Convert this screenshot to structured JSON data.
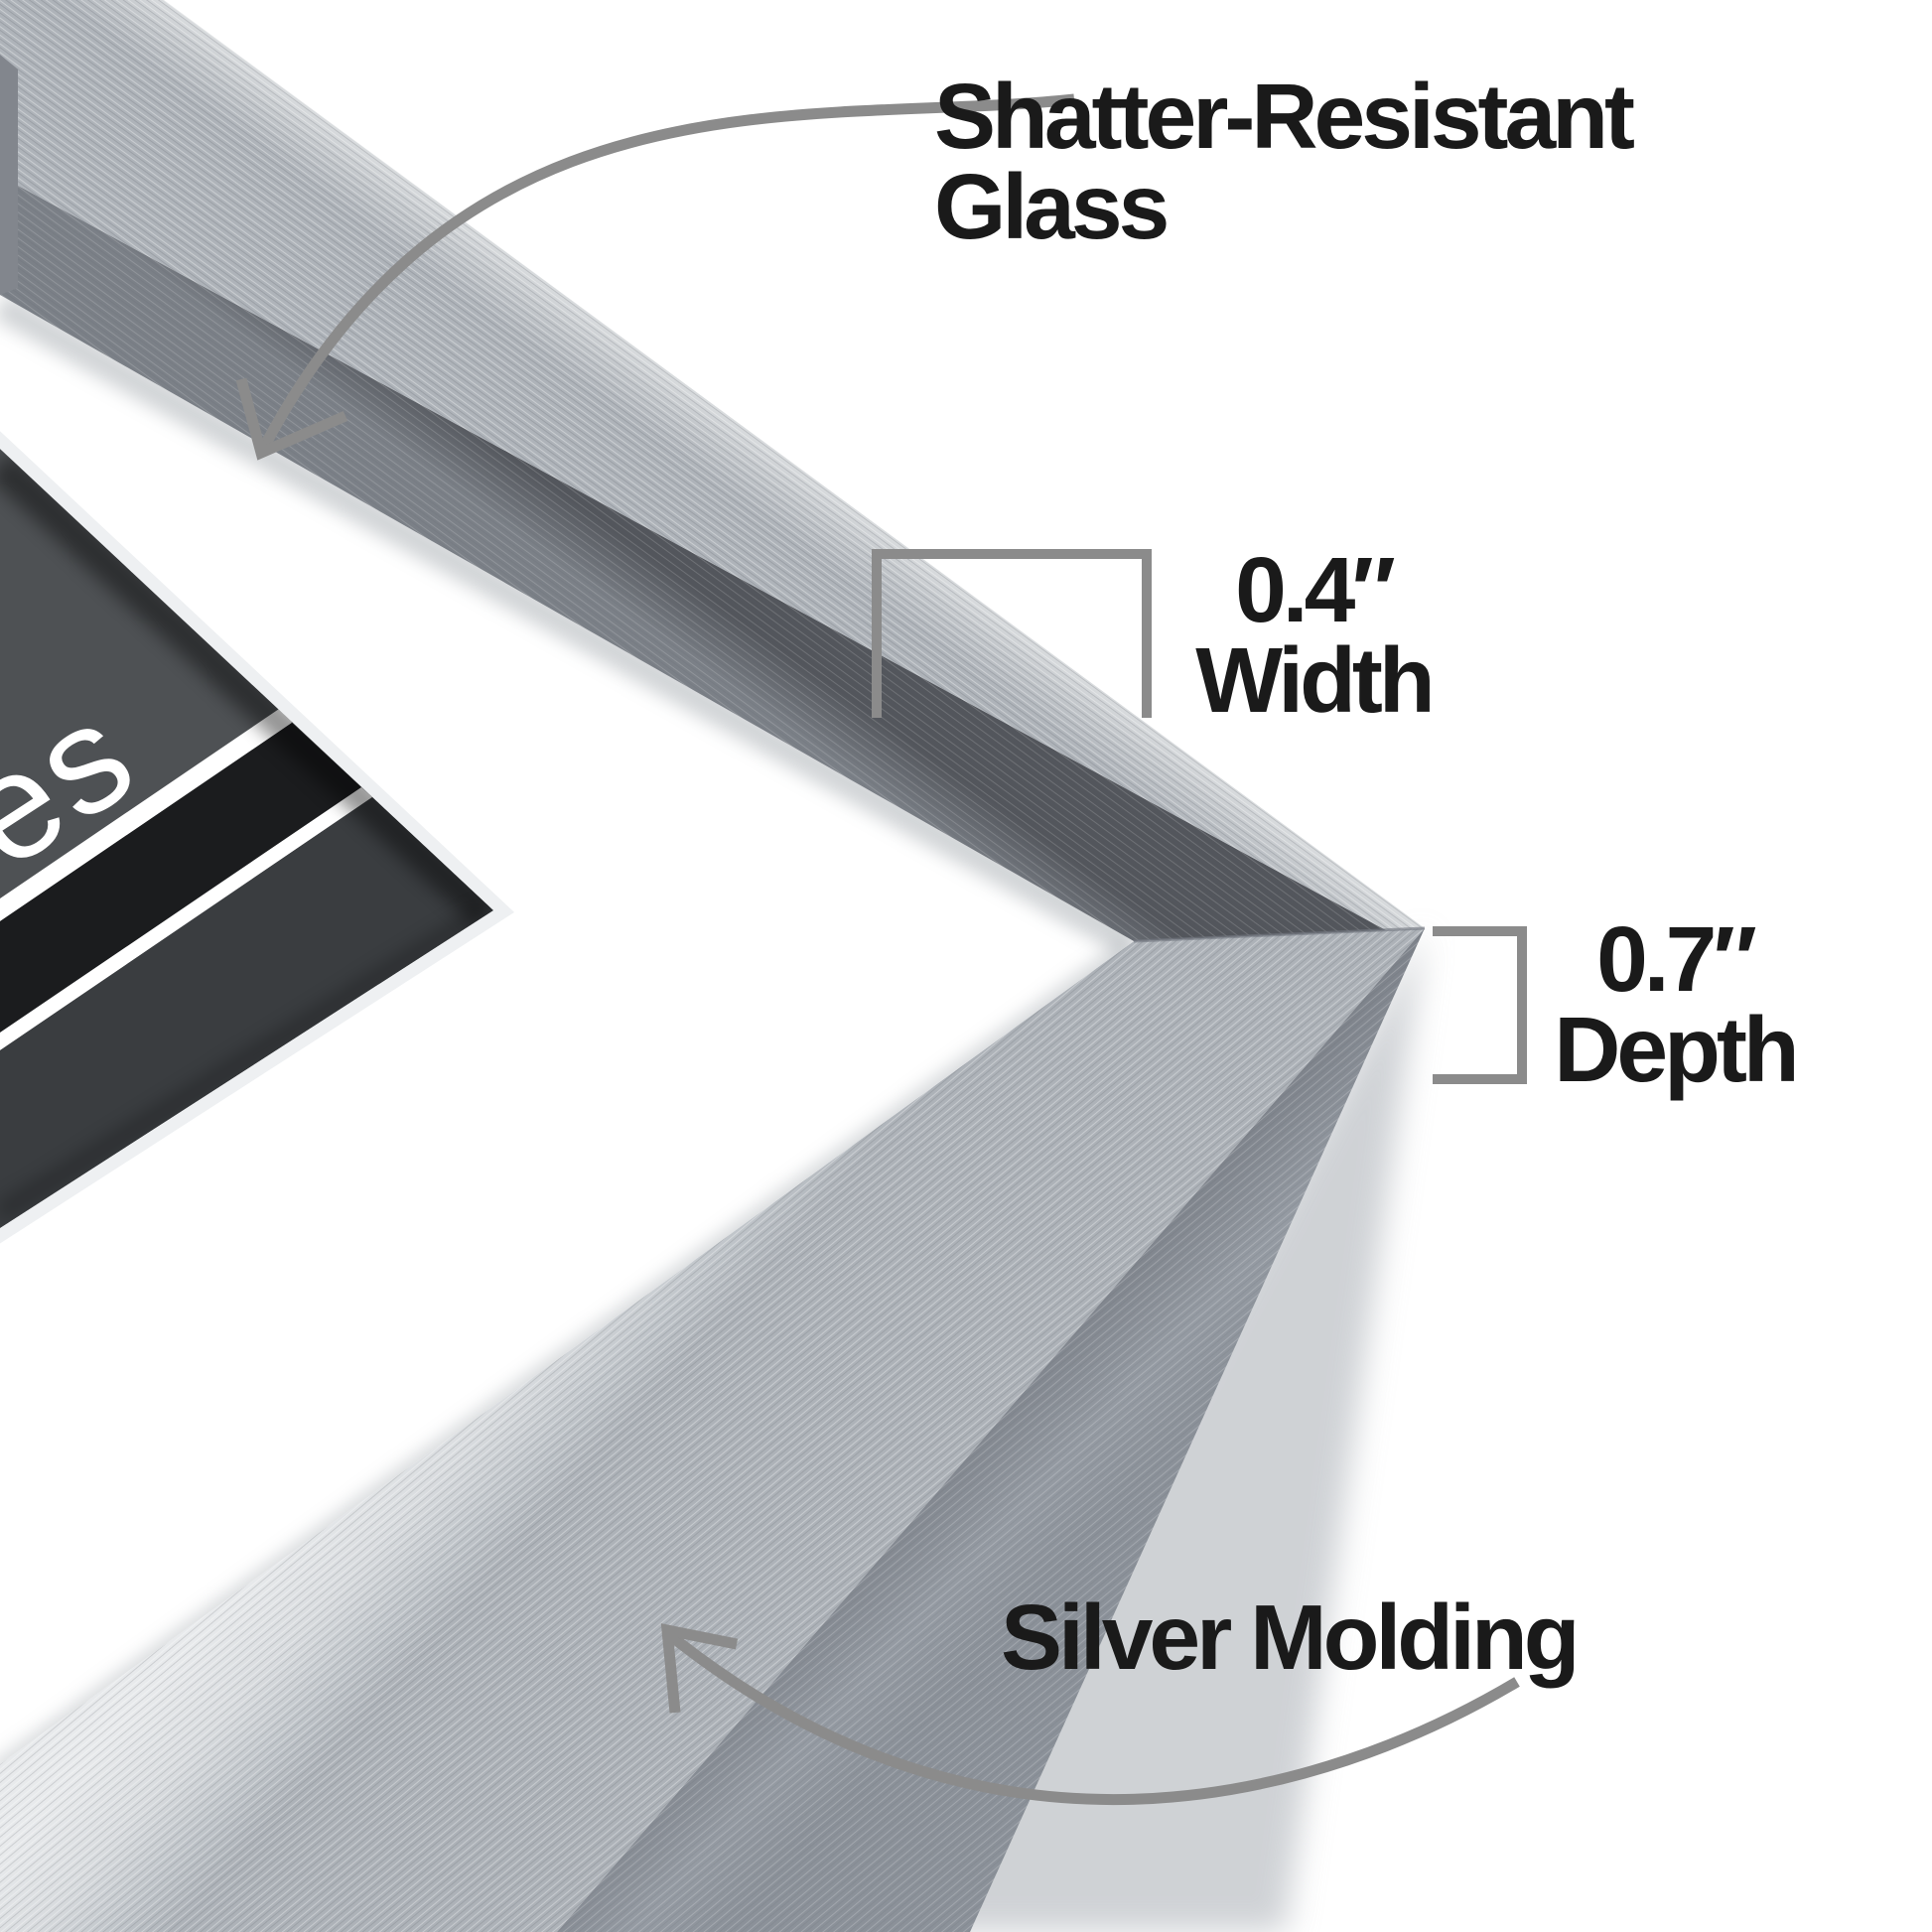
{
  "diagram": {
    "title": "Picture frame corner feature callouts",
    "labels": {
      "glass": {
        "line1": "Shatter-Resistant",
        "line2": "Glass"
      },
      "width": {
        "value": "0.4″",
        "caption": "Width"
      },
      "depth": {
        "value": "0.7″",
        "caption": "Depth"
      },
      "molding": {
        "caption": "Silver Molding"
      }
    },
    "photo_sample_text": "es",
    "colors": {
      "background": "#ffffff",
      "text": "#1a1a1a",
      "annotation_gray": "#8b8b8b",
      "silver_light": "#e9ebec",
      "silver_mid": "#c3c7cb",
      "silver_dark": "#9ba0a6",
      "frame_side": "#8b9199",
      "frame_inner_edge": "#5a5e64",
      "mat": "#ffffff",
      "mat_bevel": "#eef0f2",
      "photo_gray": "#4e5154",
      "photo_gray_dark": "#3a3d40",
      "photo_black": "#1b1c1e",
      "photo_stripe": "#ffffff"
    }
  }
}
